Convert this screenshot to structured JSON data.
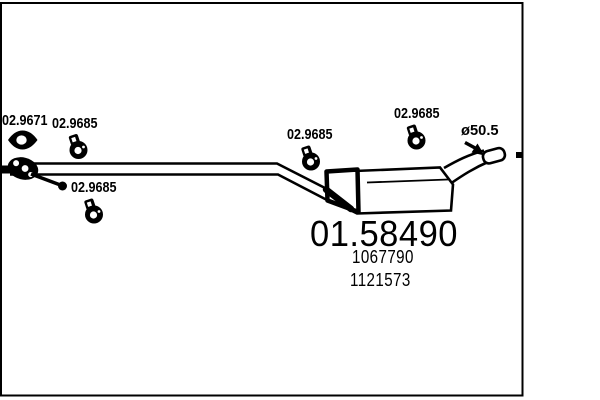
{
  "colors": {
    "background": "#ffffff",
    "ink": "#000000"
  },
  "part_labels": [
    {
      "name": "exhaust-gasket",
      "text": "02.9671"
    },
    {
      "name": "clamp-front-upper",
      "text": "02.9685"
    },
    {
      "name": "clamp-front-lower",
      "text": "02.9685"
    },
    {
      "name": "clamp-middle",
      "text": "02.9685"
    },
    {
      "name": "clamp-rear",
      "text": "02.9685"
    }
  ],
  "diameter_label": "ø50.5",
  "main_part_number": "01.58490",
  "oe_numbers": [
    "1067790",
    "1121573"
  ],
  "icons": {
    "gasket": "eye-gasket-icon",
    "clamp": "ring-clamp-icon",
    "flange": "pipe-flange-icon",
    "hanger": "hanger-rod-icon",
    "arrow": "diameter-arrow-icon",
    "end_marker": "pipe-end-marker"
  }
}
